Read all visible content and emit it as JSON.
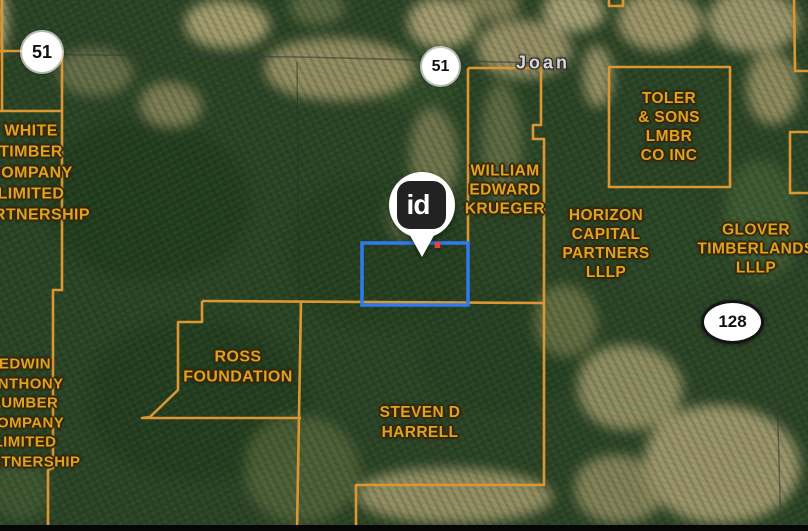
{
  "colors": {
    "label-gold": "#dfa31f",
    "parcel-line": "#dc9732",
    "subject-blue": "#2e7bf0",
    "marker-dot": "#e8413c",
    "place-gray": "#d8d8d8",
    "shield-text": "#111111"
  },
  "place": {
    "town": "Joan"
  },
  "shields": {
    "highway_51_nw": "51",
    "highway_51_center": "51",
    "highway_128": "128"
  },
  "marker": {
    "logo_text": "id",
    "logo_dot": "."
  },
  "labels": {
    "white_timber": {
      "lines": [
        "WHITE",
        "TIMBER",
        "COMPANY",
        "LIMITED",
        "PARTNERSHIP"
      ]
    },
    "edwin_anthony": {
      "lines": [
        "EDWIN",
        "ANTHONY",
        "LUMBER",
        "COMPANY",
        "LIMITED",
        "PARTNERSHIP"
      ]
    },
    "william_krueger": {
      "lines": [
        "WILLIAM",
        "EDWARD",
        "KRUEGER"
      ]
    },
    "toler_sons": {
      "lines": [
        "TOLER",
        "& SONS",
        "LMBR",
        "CO INC"
      ]
    },
    "horizon_capital": {
      "lines": [
        "HORIZON",
        "CAPITAL",
        "PARTNERS",
        "LLLP"
      ]
    },
    "glover_timberlands": {
      "lines": [
        "GLOVER",
        "TIMBERLANDS",
        "LLLP"
      ]
    },
    "ross_foundation": {
      "lines": [
        "ROSS",
        "FOUNDATION"
      ]
    },
    "steven_harrell": {
      "lines": [
        "STEVEN D",
        "HARRELL"
      ]
    }
  }
}
